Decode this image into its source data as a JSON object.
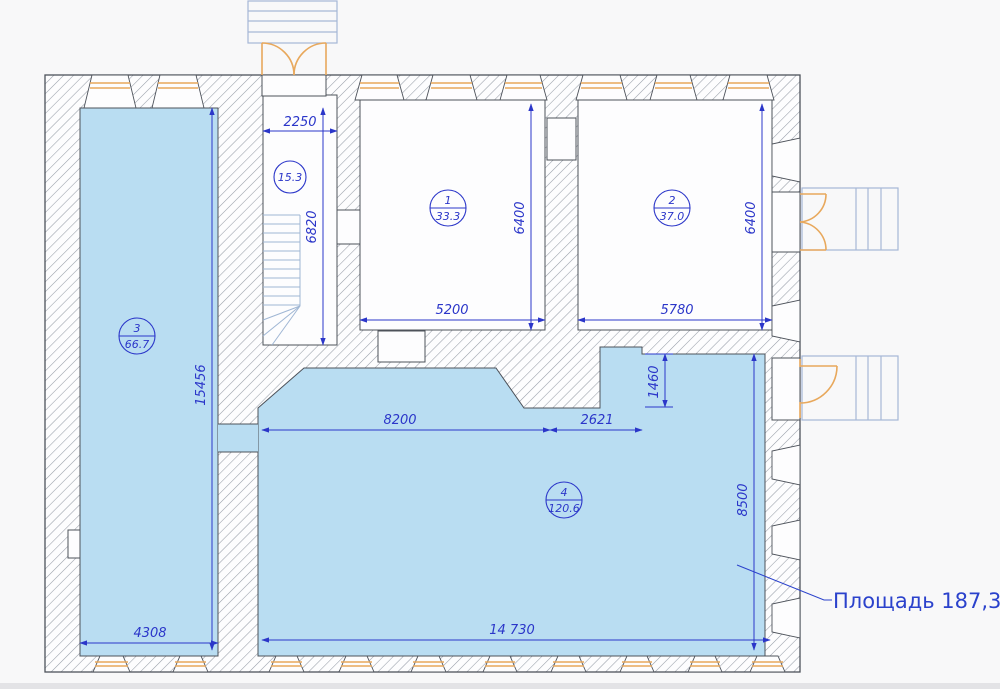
{
  "floorplan": {
    "callout": {
      "label": "Площадь 187,3м2"
    },
    "rooms": [
      {
        "number": "1",
        "area": "33.3"
      },
      {
        "number": "2",
        "area": "37.0"
      },
      {
        "number": "3",
        "area": "66.7"
      },
      {
        "number": "4",
        "area": "120.6"
      }
    ],
    "stair": {
      "area": "15.3"
    },
    "dims": {
      "stair_width": "2250",
      "stair_depth": "6820",
      "room1_width": "5200",
      "room1_depth": "6400",
      "room2_width": "5780",
      "room2_depth": "6400",
      "room3_depth": "15456",
      "room3_width": "4308",
      "room4_top_left": "8200",
      "room4_top_right": "2621",
      "room4_step": "1460",
      "room4_depth": "8500",
      "room4_width": "14 730"
    },
    "colors": {
      "room_fill": "#b9ddf2",
      "dimension_blue": "#2b36c9",
      "joinery_orange": "#e8a85c",
      "wall_outline": "#4d525a",
      "hatch_gray": "#979ea8",
      "steps_blue": "#a6b7d6"
    }
  }
}
